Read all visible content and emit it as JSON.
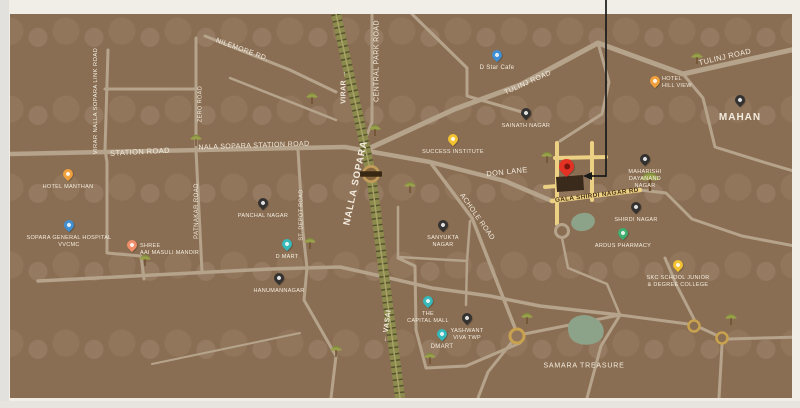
{
  "colors": {
    "page_bg": "#f1eee8",
    "map_bg": "#8a6e53",
    "road": "#b5a38b",
    "yellow_road": "#ecd083",
    "railway_band": "#8d8a4e",
    "railway_tie": "#55522e",
    "pond": "#8da389",
    "gold_ring": "#c9a24f",
    "callout_line": "#1a1a1a",
    "project_pin": "#e33224",
    "dark_pin": "#343230",
    "orange_pin": "#f0a03c",
    "blue_pin": "#3f8fd2",
    "teal_pin": "#37b9b9",
    "yellow_pin": "#f2c230",
    "green_pin": "#3fae6e",
    "salmon_pin": "#ef8e68",
    "label_text": "#f3ecdf",
    "yellow_road_label": "#4a3417"
  },
  "labels": [
    {
      "text": "VIRAR NALLA SOPARA LINK ROAD",
      "x": 97,
      "y": 101,
      "rot": -90,
      "size": 5.8
    },
    {
      "text": "ZERO ROAD",
      "x": 201,
      "y": 104,
      "rot": -90,
      "size": 5.5
    },
    {
      "text": "NILEMORE RD.",
      "x": 242,
      "y": 50,
      "rot": 20,
      "size": 7
    },
    {
      "text": "STATION ROAD",
      "x": 140,
      "y": 152,
      "rot": -3,
      "size": 7.5
    },
    {
      "text": "NALA SOPARA STATION ROAD",
      "x": 254,
      "y": 146,
      "rot": -2,
      "size": 7
    },
    {
      "text": "CENTRAL PARK ROAD",
      "x": 377,
      "y": 61,
      "rot": -90,
      "size": 7
    },
    {
      "text": "VIRAR →",
      "x": 344,
      "y": 87,
      "rot": -90,
      "size": 7,
      "bold": true
    },
    {
      "text": "NALLA SOPARA",
      "x": 356,
      "y": 183,
      "rot": -78,
      "size": 9.5,
      "bold": true,
      "ls": 1
    },
    {
      "text": "← VASAI",
      "x": 387,
      "y": 326,
      "rot": -82,
      "size": 7,
      "bold": true
    },
    {
      "text": "TULINJ ROAD",
      "x": 528,
      "y": 83,
      "rot": -24,
      "size": 7
    },
    {
      "text": "TULINJ ROAD",
      "x": 725,
      "y": 57,
      "rot": -13,
      "size": 7.5
    },
    {
      "text": "DON LANE",
      "x": 507,
      "y": 172,
      "rot": -6,
      "size": 7.5
    },
    {
      "text": "ACHOLE ROAD",
      "x": 477,
      "y": 217,
      "rot": 55,
      "size": 7
    },
    {
      "text": "ST. DEPOT ROAD",
      "x": 302,
      "y": 215,
      "rot": -90,
      "size": 5.5
    },
    {
      "text": "PATNAKAR ROAD",
      "x": 197,
      "y": 211,
      "rot": -90,
      "size": 6
    },
    {
      "text": "GALA SHIRDI NAGAR RD",
      "x": 597,
      "y": 196,
      "rot": -7,
      "size": 6.3,
      "bold": true,
      "color": "#4a3417"
    },
    {
      "text": "SAMARA TREASURE",
      "x": 584,
      "y": 366,
      "rot": 0,
      "size": 7,
      "ls": 0.8
    }
  ],
  "pois": [
    {
      "name": "project-location",
      "lines": [],
      "x": 566,
      "y": 177,
      "color": "#e33224",
      "big": true
    },
    {
      "name": "hotel-manthan",
      "lines": [
        "HOTEL MANTHAN"
      ],
      "x": 68,
      "y": 181,
      "color": "#f0a03c"
    },
    {
      "name": "sopara-general-hospital",
      "lines": [
        "SOPARA GENERAL HOSPITAL",
        "VVCMC"
      ],
      "x": 69,
      "y": 232,
      "color": "#3f8fd2"
    },
    {
      "name": "shree-aai-masuli-mandir",
      "lines": [
        "SHREE",
        "AAI MASULI MANDIR"
      ],
      "x": 132,
      "y": 252,
      "color": "#ef8e68",
      "align": "left",
      "dx": 8,
      "dy": -9
    },
    {
      "name": "panchal-nagar",
      "lines": [
        "PANCHAL NAGAR"
      ],
      "x": 263,
      "y": 210,
      "color": "#343230"
    },
    {
      "name": "d-mart",
      "lines": [
        "D MART"
      ],
      "x": 287,
      "y": 251,
      "color": "#37b9b9"
    },
    {
      "name": "hanumannagar",
      "lines": [
        "HANUMANNAGAR"
      ],
      "x": 279,
      "y": 285,
      "color": "#343230"
    },
    {
      "name": "d-star-cafe",
      "lines": [
        "D Star Cafe"
      ],
      "x": 497,
      "y": 62,
      "color": "#3f8fd2",
      "size": 6
    },
    {
      "name": "sainath-nagar",
      "lines": [
        "SAINATH NAGAR"
      ],
      "x": 526,
      "y": 120,
      "color": "#343230"
    },
    {
      "name": "success-institute",
      "lines": [
        "SUCCESS INSTITUTE"
      ],
      "x": 453,
      "y": 146,
      "color": "#f2c230"
    },
    {
      "name": "hotel-hill-view",
      "lines": [
        "HOTEL",
        "HILL VIEW"
      ],
      "x": 655,
      "y": 88,
      "color": "#f0a03c",
      "align": "left",
      "dx": 7,
      "dy": -12
    },
    {
      "name": "mahan",
      "lines": [
        "MAHAN"
      ],
      "x": 740,
      "y": 107,
      "color": "#343230",
      "size": 10,
      "bold": true,
      "ls": 1,
      "dy": 4
    },
    {
      "name": "maharishi-dayanand-nagar",
      "lines": [
        "MAHARISHI",
        "DAYANAND",
        "NAGAR"
      ],
      "x": 645,
      "y": 166,
      "color": "#343230"
    },
    {
      "name": "shirdi-nagar",
      "lines": [
        "SHIRDI NAGAR"
      ],
      "x": 636,
      "y": 214,
      "color": "#343230"
    },
    {
      "name": "ardus-pharmacy",
      "lines": [
        "ARDUS PHARMACY"
      ],
      "x": 623,
      "y": 240,
      "color": "#3fae6e"
    },
    {
      "name": "skc-school",
      "lines": [
        "SKC SCHOOL JUNIOR",
        "& DEGREE COLLEGE"
      ],
      "x": 678,
      "y": 272,
      "color": "#f2c230"
    },
    {
      "name": "the-capital-mall",
      "lines": [
        "THE",
        "CAPITAL MALL"
      ],
      "x": 428,
      "y": 308,
      "color": "#37b9b9"
    },
    {
      "name": "yashwant-viva-twp",
      "lines": [
        "YASHWANT",
        "VIVA TWP"
      ],
      "x": 467,
      "y": 325,
      "color": "#343230"
    },
    {
      "name": "dmart",
      "lines": [
        "DMART"
      ],
      "x": 442,
      "y": 341,
      "color": "#37b9b9",
      "size": 6
    },
    {
      "name": "sanyukta-nagar",
      "lines": [
        "SANYUKTA",
        "NAGAR"
      ],
      "x": 443,
      "y": 232,
      "color": "#343230"
    }
  ],
  "trees": [
    {
      "x": 196,
      "y": 146
    },
    {
      "x": 312,
      "y": 104
    },
    {
      "x": 375,
      "y": 136
    },
    {
      "x": 410,
      "y": 193
    },
    {
      "x": 547,
      "y": 163
    },
    {
      "x": 650,
      "y": 191,
      "s": 1.7
    },
    {
      "x": 697,
      "y": 64
    },
    {
      "x": 310,
      "y": 249
    },
    {
      "x": 145,
      "y": 266
    },
    {
      "x": 336,
      "y": 357
    },
    {
      "x": 430,
      "y": 364
    },
    {
      "x": 527,
      "y": 324
    },
    {
      "x": 731,
      "y": 325
    }
  ]
}
